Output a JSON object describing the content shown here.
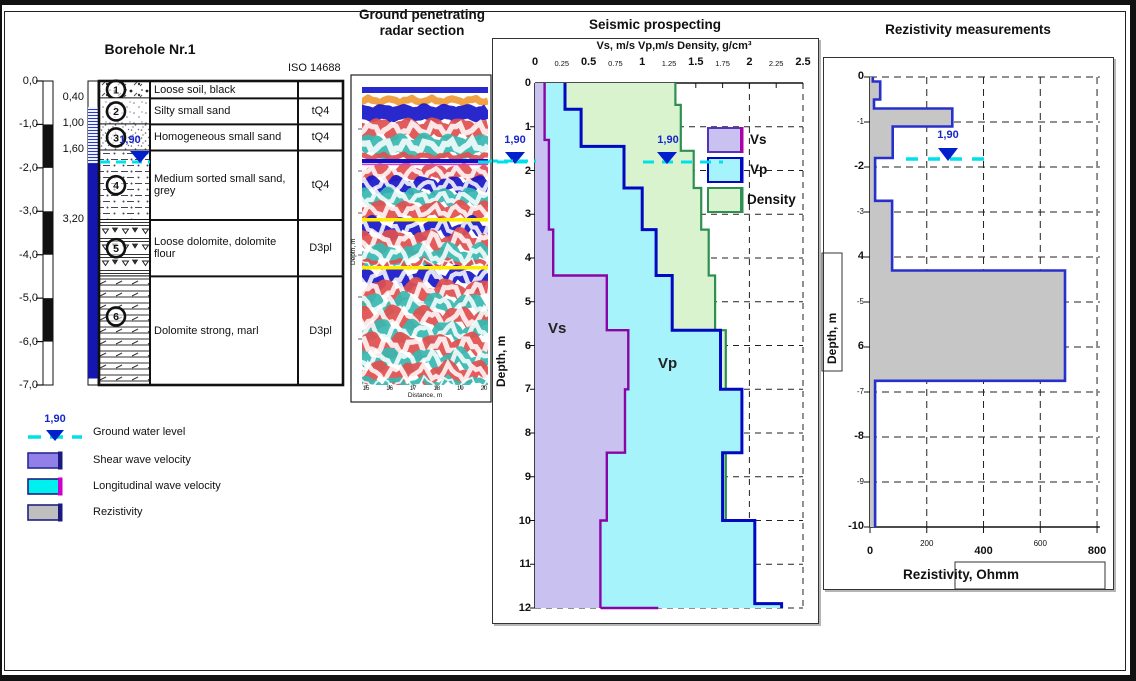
{
  "borehole": {
    "title": "Borehole Nr.1",
    "standard": "ISO 14688",
    "depth_axis_labels": [
      "0,0",
      "-1,0",
      "-2,0",
      "-3,0",
      "-4,0",
      "-5,0",
      "-6,0",
      "-7,0"
    ],
    "contact_depths": [
      {
        "label": "0,40",
        "depth": 0.4
      },
      {
        "label": "1,00",
        "depth": 1.0
      },
      {
        "label": "1,60",
        "depth": 1.6
      },
      {
        "label": "3,20",
        "depth": 3.2
      }
    ],
    "water_level": {
      "label": "1,90",
      "depth_m": 1.9
    },
    "layers": [
      {
        "no": "1",
        "description": "Loose soil, black",
        "classification": "",
        "from": 0,
        "to": 0.4,
        "pattern": "p-top"
      },
      {
        "no": "2",
        "description": "Silty small sand",
        "classification": "tQ4",
        "from": 0.4,
        "to": 1.0,
        "pattern": "p-sand1"
      },
      {
        "no": "3",
        "description": "Homogeneous small sand",
        "classification": "tQ4",
        "from": 1.0,
        "to": 1.6,
        "pattern": "p-sand2"
      },
      {
        "no": "4",
        "description": "Medium sorted small sand, grey",
        "classification": "tQ4",
        "from": 1.6,
        "to": 3.2,
        "pattern": "p-dashdot"
      },
      {
        "no": "5",
        "description": "Loose dolomite, dolomite flour",
        "classification": "D3pl",
        "from": 3.2,
        "to": 4.5,
        "pattern": "p-dolf"
      },
      {
        "no": "6",
        "description": "Dolomite strong, marl",
        "classification": "D3pl",
        "from": 4.5,
        "to": 7.0,
        "pattern": "p-marl"
      }
    ],
    "legend": {
      "water_value": "1,90",
      "items": [
        {
          "swatch": "water",
          "label": "Ground water level"
        },
        {
          "swatch": "shear",
          "label": "Shear wave velocity"
        },
        {
          "swatch": "long",
          "label": "Longitudinal wave velocity"
        },
        {
          "swatch": "rez",
          "label": "Rezistivity"
        }
      ]
    }
  },
  "gpr": {
    "title_line1": "Ground penetrating",
    "title_line2": "radar section",
    "xlabel": "Distance, m",
    "x_ticks": [
      "15",
      "16",
      "17",
      "18",
      "19",
      "20"
    ],
    "ylabel": "Depth, m",
    "band_colors": {
      "navy": "#1818c8",
      "red": "#e05050",
      "teal": "#38b8b0",
      "orange": "#f09a38",
      "yellow": "#ffee00",
      "magenta": "#d040c0"
    },
    "bands": [
      [
        87,
        6,
        "navy",
        0
      ],
      [
        97,
        7,
        "orange",
        1
      ],
      [
        106,
        14,
        "navy",
        1
      ],
      [
        122,
        14,
        "red",
        2
      ],
      [
        138,
        16,
        "teal",
        2
      ],
      [
        154,
        5,
        "red",
        1
      ],
      [
        167,
        12,
        "red",
        2
      ],
      [
        180,
        11,
        "navy",
        2
      ],
      [
        192,
        12,
        "teal",
        2
      ],
      [
        205,
        12,
        "red",
        2
      ],
      [
        223,
        11,
        "navy",
        3
      ],
      [
        235,
        13,
        "red",
        3
      ],
      [
        249,
        12,
        "teal",
        3
      ],
      [
        262,
        4,
        "red",
        2
      ],
      [
        272,
        12,
        "navy",
        3
      ],
      [
        285,
        13,
        "red",
        3
      ],
      [
        299,
        12,
        "teal",
        3
      ],
      [
        312,
        13,
        "red",
        3
      ],
      [
        326,
        12,
        "teal",
        3
      ],
      [
        339,
        14,
        "red",
        3
      ],
      [
        354,
        12,
        "teal",
        3
      ],
      [
        367,
        12,
        "red",
        3
      ],
      [
        380,
        5,
        "teal",
        2
      ]
    ]
  },
  "seismic": {
    "title": "Seismic prospecting",
    "top_axis_label": "Vs, m/s  Vp,m/s  Density, g/cm³",
    "x_ticks": [
      {
        "label": "0",
        "v": 0,
        "major": true
      },
      {
        "label": "0.25",
        "v": 0.25,
        "major": false
      },
      {
        "label": "0.5",
        "v": 0.5,
        "major": true
      },
      {
        "label": "0.75",
        "v": 0.75,
        "major": false
      },
      {
        "label": "1",
        "v": 1,
        "major": true
      },
      {
        "label": "1.25",
        "v": 1.25,
        "major": false
      },
      {
        "label": "1.5",
        "v": 1.5,
        "major": true
      },
      {
        "label": "1.75",
        "v": 1.75,
        "major": false
      },
      {
        "label": "2",
        "v": 2,
        "major": true
      },
      {
        "label": "2.25",
        "v": 2.25,
        "major": false
      },
      {
        "label": "2.5",
        "v": 2.5,
        "major": true
      }
    ],
    "depth_ticks": [
      "0",
      "1",
      "2",
      "3",
      "4",
      "5",
      "6",
      "7",
      "8",
      "9",
      "10",
      "11",
      "12"
    ],
    "ylabel": "Depth, m",
    "area_label_vs": "Vs",
    "area_label_vp": "Vp",
    "water_label": "1,90",
    "legend": [
      {
        "name": "Vs",
        "fill": "#c9c2f0",
        "line": "#5533bb",
        "cap": "#aa00aa"
      },
      {
        "name": "Vp",
        "fill": "#a6f3fb",
        "line": "#0008c0",
        "cap": "#0008c0"
      },
      {
        "name": "Density",
        "fill": "#d9f3cf",
        "line": "#2e9050",
        "cap": "#2e9050"
      }
    ]
  },
  "resistivity": {
    "title": "Rezistivity measurements",
    "xlabel": "Rezistivity, Ohmm",
    "ylabel": "Depth, m",
    "water_label": "1,90",
    "y_tick_labels": [
      "0",
      "-1",
      "-2",
      "-3",
      "4",
      "-5",
      "6",
      "-7",
      "-8",
      "-9",
      "-10"
    ],
    "x_ticks": [
      {
        "label": "0",
        "v": 0,
        "major": true
      },
      {
        "label": "200",
        "v": 200,
        "major": false
      },
      {
        "label": "400",
        "v": 400,
        "major": true
      },
      {
        "label": "600",
        "v": 600,
        "major": false
      },
      {
        "label": "800",
        "v": 800,
        "major": true
      }
    ]
  },
  "chart_data": [
    {
      "id": "seismic",
      "type": "area",
      "subtype": "step-depth-profile",
      "title": "Seismic prospecting",
      "xlabel": "Vs, m/s  Vp,m/s  Density, g/cm3",
      "ylabel": "Depth, m",
      "xlim": [
        0,
        2.5
      ],
      "depth_range_m": [
        0,
        12
      ],
      "grid": "dashed",
      "legend_position": "inside-top-right",
      "water_level_depth_m": 1.9,
      "series": [
        {
          "name": "Density",
          "units": "g/cm3",
          "steps_value_from_to": [
            [
              1.31,
              0,
              0.5
            ],
            [
              1.36,
              0.5,
              1.55
            ],
            [
              1.48,
              1.55,
              2.4
            ],
            [
              1.55,
              2.4,
              3.35
            ],
            [
              1.62,
              3.35,
              4.4
            ],
            [
              1.68,
              4.4,
              5.65
            ],
            [
              1.78,
              5.65,
              12
            ]
          ]
        },
        {
          "name": "Vp",
          "units": "km/s",
          "steps_value_from_to": [
            [
              0.28,
              0,
              0.6
            ],
            [
              0.43,
              0.6,
              1.45
            ],
            [
              0.83,
              1.45,
              2.4
            ],
            [
              1.0,
              2.4,
              3.35
            ],
            [
              1.13,
              3.35,
              4.4
            ],
            [
              1.28,
              4.4,
              5.65
            ],
            [
              1.73,
              5.65,
              7
            ],
            [
              1.93,
              7,
              8.45
            ],
            [
              1.75,
              8.45,
              10
            ],
            [
              2.05,
              10,
              11.9
            ],
            [
              2.3,
              11.9,
              12
            ]
          ]
        },
        {
          "name": "Vs",
          "units": "km/s",
          "steps_value_from_to": [
            [
              0.09,
              0,
              1.3
            ],
            [
              0.13,
              1.3,
              3.35
            ],
            [
              0.17,
              3.35,
              4.4
            ],
            [
              0.67,
              4.4,
              5.65
            ],
            [
              0.87,
              5.65,
              7
            ],
            [
              0.84,
              7,
              8.45
            ],
            [
              0.67,
              8.45,
              10
            ],
            [
              0.61,
              10,
              12
            ]
          ]
        }
      ],
      "vgrid_values": [
        1,
        2,
        2.5
      ]
    },
    {
      "id": "resistivity",
      "type": "area",
      "subtype": "step-depth-profile",
      "title": "Rezistivity measurements",
      "xlabel": "Rezistivity, Ohmm",
      "ylabel": "Depth, m",
      "xlim": [
        0,
        800
      ],
      "depth_range_m": [
        0,
        10
      ],
      "grid": "dashed",
      "water_level_depth_m": 1.9,
      "series": [
        {
          "name": "Rezistivity",
          "units": "Ohm m",
          "steps_value_from_to": [
            [
              10,
              0,
              0.1
            ],
            [
              36,
              0.1,
              0.5
            ],
            [
              14,
              0.5,
              0.7
            ],
            [
              290,
              0.7,
              1.1
            ],
            [
              80,
              1.1,
              1.8
            ],
            [
              18,
              1.8,
              2.75
            ],
            [
              78,
              2.75,
              4.3
            ],
            [
              687,
              4.3,
              6.75
            ],
            [
              18,
              6.75,
              10
            ]
          ]
        }
      ],
      "vgrid_values": [
        200,
        400,
        600,
        800
      ]
    }
  ],
  "colors": {
    "vs_line": "#8806a6",
    "vs_fill": "#c9c2f0",
    "vp_line": "#0008c0",
    "vp_fill": "#a6f3fb",
    "den_line": "#2e9050",
    "den_fill": "#d9f3cf",
    "res_line": "#2830cc",
    "res_fill": "#c6c6c6",
    "water_cyan": "#00e0e8",
    "water_blue": "#0020cc",
    "water_text": "#1828c8",
    "borehole_blue": "#1515b0"
  }
}
